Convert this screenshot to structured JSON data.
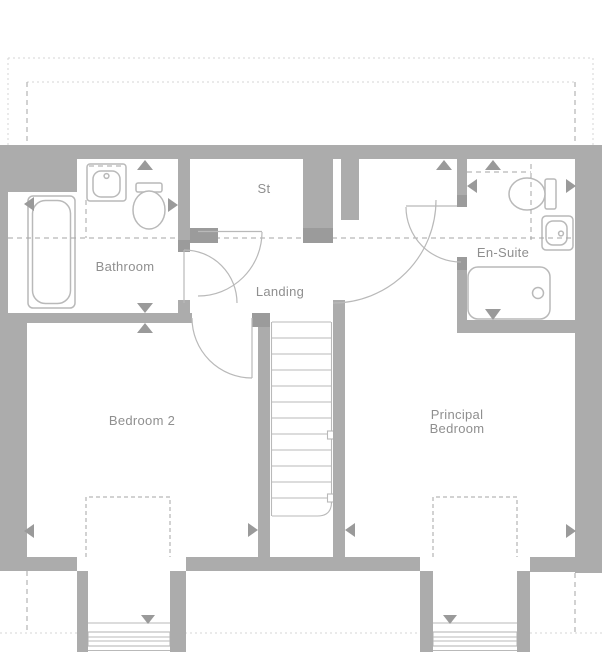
{
  "labels": {
    "bathroom": "Bathroom",
    "storage": "St",
    "landing": "Landing",
    "ensuite": "En-Suite",
    "bedroom2": "Bedroom 2",
    "principal_line1": "Principal",
    "principal_line2": "Bedroom"
  },
  "colors": {
    "wall": "#acacac",
    "jamb": "#9b9b9b",
    "marker": "#9a9a9a",
    "fixture": "#b9b9b9",
    "dash": "#a6a6a6",
    "dot": "#d4d4d4",
    "label_text": "#8f8f8f",
    "background": "#ffffff"
  },
  "fixtures": [
    "bathtub",
    "bathroom-sink",
    "bathroom-toilet",
    "ensuite-toilet",
    "ensuite-sink",
    "shower-tray",
    "stairs",
    "bedroom2-dormer-window",
    "principal-dormer-window"
  ]
}
